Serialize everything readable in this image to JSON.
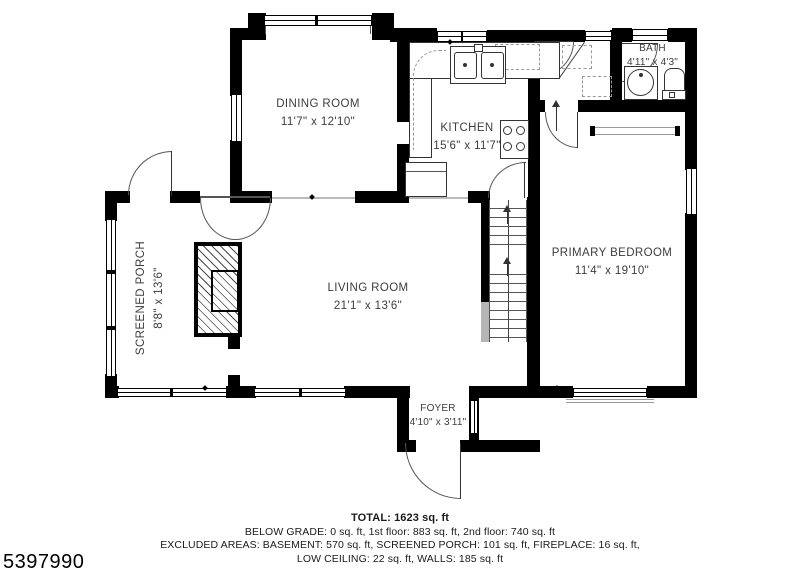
{
  "listing_id": "5397990",
  "rooms": [
    {
      "name": "DINING ROOM",
      "dims": "11'7\" x 12'10\""
    },
    {
      "name": "KITCHEN",
      "dims": "15'6\" x 11'7\""
    },
    {
      "name": "BATH",
      "dims": "4'11\" x 4'3\""
    },
    {
      "name": "PRIMARY BEDROOM",
      "dims": "11'4\" x 19'10\""
    },
    {
      "name": "LIVING ROOM",
      "dims": "21'1\" x 13'6\""
    },
    {
      "name": "SCREENED PORCH",
      "dims": "8'8\" x 13'6\""
    },
    {
      "name": "FOYER",
      "dims": "4'10\" x 3'11\""
    }
  ],
  "summary": {
    "total": "TOTAL: 1623 sq. ft",
    "line1": "BELOW GRADE: 0 sq. ft, 1st floor: 883 sq. ft, 2nd floor: 740 sq. ft",
    "line2": "EXCLUDED AREAS: BASEMENT: 570 sq. ft, SCREENED PORCH: 101 sq. ft, FIREPLACE: 16 sq. ft,",
    "line3": "LOW CEILING: 22 sq. ft, WALLS: 185 sq. ft"
  },
  "colors": {
    "wall": "#000000",
    "door_line": "#555555",
    "label_text": "#3d3d3d"
  }
}
